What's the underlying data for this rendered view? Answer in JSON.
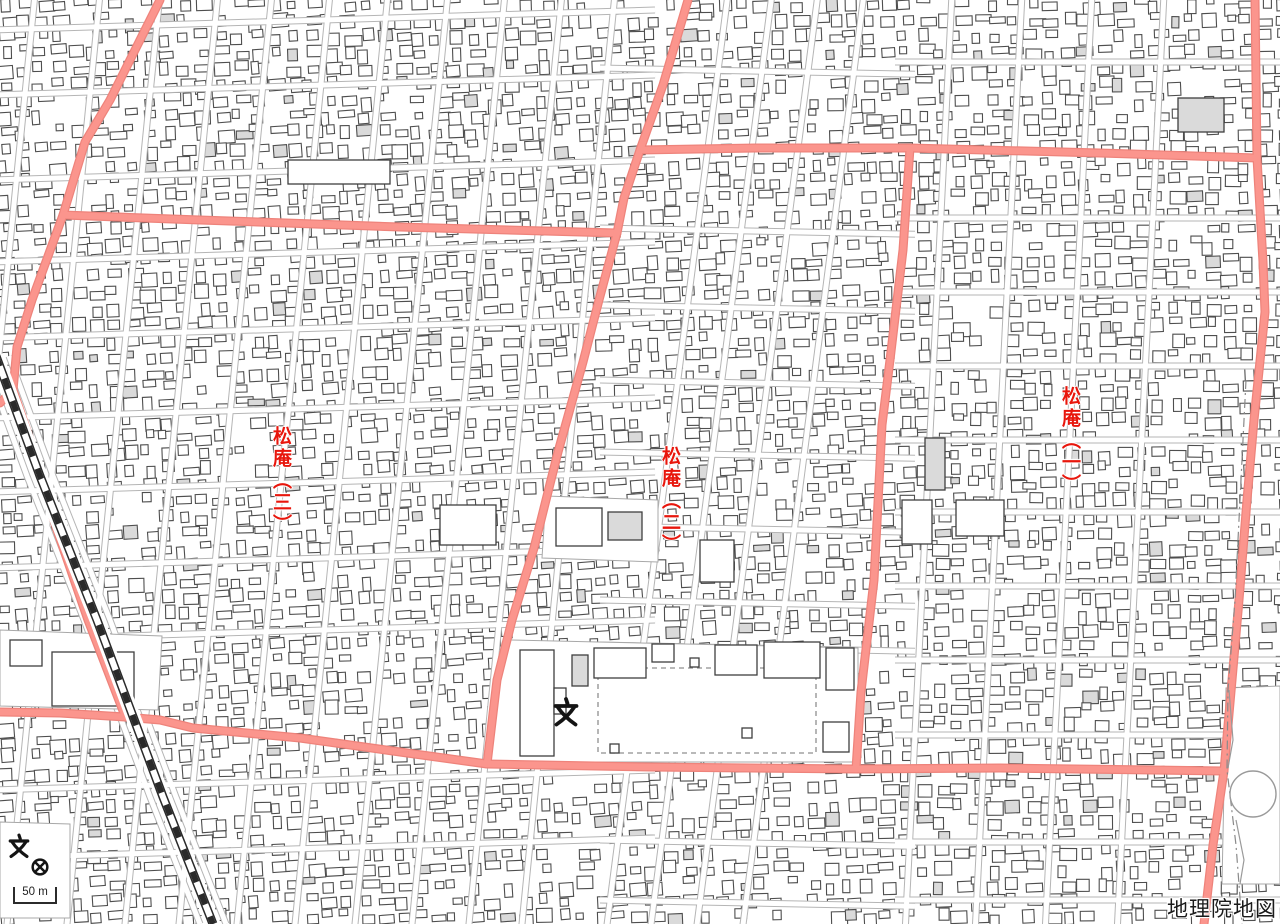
{
  "map": {
    "width": 1280,
    "height": 924,
    "background": "#ffffff"
  },
  "colors": {
    "road_pink": "#fb958d",
    "road_pink_edge": "#ee837b",
    "street_edge": "#b5b5b5",
    "street_fill": "#ffffff",
    "building_stroke": "#4e4e4e",
    "building_gray": "#dadada",
    "label_red": "#e8160c",
    "rail_dark": "#2a2a2a",
    "parcel_edge": "#a8a8a8"
  },
  "attribution": {
    "text": "地理院地図"
  },
  "scale_bar": {
    "label": "50 m",
    "x": 14,
    "y_top": 887,
    "y_bottom": 903,
    "width": 42
  },
  "district_labels": [
    {
      "text": "松庵（三）",
      "x": 283,
      "y": 426
    },
    {
      "text": "松庵（二）",
      "x": 672,
      "y": 446
    },
    {
      "text": "松庵（一）",
      "x": 1072,
      "y": 386
    }
  ],
  "symbols": [
    {
      "kind": "school",
      "x": 566,
      "y": 712,
      "size": 30
    },
    {
      "kind": "school",
      "x": 19,
      "y": 846,
      "size": 25
    },
    {
      "kind": "police_station",
      "x": 40,
      "y": 867,
      "size": 22
    }
  ],
  "major_roads": [
    {
      "id": "railside-road",
      "points": [
        [
          160,
          0
        ],
        [
          110,
          100
        ],
        [
          85,
          142
        ],
        [
          63,
          215
        ],
        [
          32,
          300
        ],
        [
          17,
          347
        ],
        [
          13,
          390
        ],
        [
          30,
          440
        ],
        [
          57,
          530
        ],
        [
          88,
          620
        ],
        [
          125,
          716
        ]
      ]
    },
    {
      "id": "railside-spur",
      "points": [
        [
          13,
          390
        ],
        [
          0,
          403
        ]
      ]
    },
    {
      "id": "upper-west-road",
      "points": [
        [
          63,
          215
        ],
        [
          200,
          220
        ],
        [
          400,
          227
        ],
        [
          617,
          233
        ]
      ]
    },
    {
      "id": "main-diagonal-road",
      "points": [
        [
          688,
          0
        ],
        [
          663,
          85
        ],
        [
          640,
          150
        ],
        [
          624,
          198
        ],
        [
          617,
          233
        ],
        [
          599,
          300
        ],
        [
          583,
          362
        ],
        [
          558,
          452
        ],
        [
          534,
          548
        ],
        [
          512,
          620
        ],
        [
          497,
          680
        ],
        [
          487,
          764
        ]
      ]
    },
    {
      "id": "upper-east-road",
      "points": [
        [
          640,
          150
        ],
        [
          755,
          148
        ],
        [
          910,
          148
        ],
        [
          1100,
          153
        ],
        [
          1257,
          158
        ]
      ]
    },
    {
      "id": "mid-vertical-road",
      "points": [
        [
          910,
          148
        ],
        [
          903,
          250
        ],
        [
          890,
          360
        ],
        [
          882,
          425
        ],
        [
          874,
          580
        ],
        [
          861,
          692
        ],
        [
          856,
          769
        ]
      ]
    },
    {
      "id": "bottom-road",
      "points": [
        [
          0,
          712
        ],
        [
          60,
          713
        ],
        [
          125,
          717
        ],
        [
          160,
          720
        ],
        [
          193,
          728
        ],
        [
          300,
          738
        ],
        [
          400,
          752
        ],
        [
          487,
          764
        ],
        [
          650,
          767
        ],
        [
          856,
          769
        ],
        [
          1000,
          768
        ],
        [
          1224,
          771
        ]
      ]
    },
    {
      "id": "right-vertical-road",
      "points": [
        [
          1255,
          0
        ],
        [
          1257,
          158
        ],
        [
          1263,
          262
        ],
        [
          1265,
          312
        ],
        [
          1254,
          420
        ],
        [
          1247,
          500
        ],
        [
          1239,
          600
        ],
        [
          1232,
          680
        ],
        [
          1224,
          771
        ],
        [
          1213,
          845
        ],
        [
          1204,
          924
        ]
      ]
    }
  ],
  "railway": {
    "points": [
      [
        -4,
        356
      ],
      [
        40,
        476
      ],
      [
        97,
        620
      ],
      [
        163,
        797
      ],
      [
        213,
        924
      ]
    ]
  },
  "streets": {
    "zones": [
      {
        "name": "west",
        "x0": -10,
        "x1": 655,
        "verticals": {
          "xs": [
            35,
            100,
            160,
            218,
            272,
            330,
            388,
            448,
            505,
            562,
            615
          ],
          "lean": -0.1
        },
        "horizontals": {
          "ys": [
            30,
            95,
            180,
            262,
            338,
            418,
            492,
            568,
            640,
            790,
            858
          ],
          "slope": -0.03
        }
      },
      {
        "name": "center",
        "x0": 600,
        "x1": 915,
        "verticals": {
          "xs": [
            728,
            772,
            818,
            864
          ],
          "lean": -0.13
        },
        "horizontals": {
          "ys": [
            68,
            228,
            305,
            380,
            452,
            526,
            600,
            645,
            840,
            900
          ],
          "slope": 0.02
        }
      },
      {
        "name": "east",
        "x0": 895,
        "x1": 1280,
        "verticals": {
          "xs": [
            952,
            1022,
            1092,
            1164
          ],
          "lean": -0.05
        },
        "horizontals": {
          "ys": [
            62,
            218,
            292,
            366,
            440,
            512,
            586,
            660,
            735,
            842,
            900
          ],
          "slope": 0
        }
      }
    ],
    "extra": [
      {
        "points": [
          [
            -17,
            356
          ],
          [
            27,
            476
          ],
          [
            84,
            620
          ],
          [
            150,
            797
          ],
          [
            200,
            924
          ]
        ]
      },
      {
        "points": [
          [
            9,
            356
          ],
          [
            53,
            476
          ],
          [
            110,
            620
          ],
          [
            176,
            797
          ],
          [
            226,
            924
          ]
        ]
      }
    ]
  },
  "parcels": [
    {
      "id": "school-campus",
      "polygon": [
        [
          512,
          640
        ],
        [
          858,
          648
        ],
        [
          858,
          762
        ],
        [
          486,
          762
        ],
        [
          504,
          640
        ]
      ],
      "dashed_rect": {
        "x": 598,
        "y": 668,
        "w": 218,
        "h": 85
      },
      "buildings": [
        {
          "x": 520,
          "y": 650,
          "w": 34,
          "h": 106,
          "fill": "white"
        },
        {
          "x": 554,
          "y": 688,
          "w": 12,
          "h": 26,
          "fill": "white"
        },
        {
          "x": 572,
          "y": 655,
          "w": 16,
          "h": 31,
          "fill": "gray"
        },
        {
          "x": 594,
          "y": 648,
          "w": 52,
          "h": 30,
          "fill": "white"
        },
        {
          "x": 652,
          "y": 644,
          "w": 22,
          "h": 18,
          "fill": "white"
        },
        {
          "x": 690,
          "y": 658,
          "w": 9,
          "h": 9,
          "fill": "white"
        },
        {
          "x": 715,
          "y": 645,
          "w": 42,
          "h": 30,
          "fill": "white"
        },
        {
          "x": 764,
          "y": 642,
          "w": 56,
          "h": 36,
          "fill": "white"
        },
        {
          "x": 826,
          "y": 648,
          "w": 28,
          "h": 42,
          "fill": "white"
        },
        {
          "x": 823,
          "y": 722,
          "w": 26,
          "h": 30,
          "fill": "white"
        },
        {
          "x": 610,
          "y": 744,
          "w": 9,
          "h": 9,
          "fill": "white"
        },
        {
          "x": 742,
          "y": 728,
          "w": 10,
          "h": 10,
          "fill": "white"
        }
      ]
    },
    {
      "id": "west-block",
      "polygon": [
        [
          0,
          630
        ],
        [
          162,
          636
        ],
        [
          158,
          710
        ],
        [
          0,
          706
        ]
      ],
      "buildings": [
        {
          "x": 10,
          "y": 640,
          "w": 32,
          "h": 26,
          "fill": "white"
        },
        {
          "x": 52,
          "y": 652,
          "w": 82,
          "h": 54,
          "fill": "white"
        }
      ]
    },
    {
      "id": "mid-block",
      "polygon": [
        [
          546,
          496
        ],
        [
          658,
          500
        ],
        [
          658,
          562
        ],
        [
          542,
          558
        ]
      ],
      "buildings": [
        {
          "x": 556,
          "y": 508,
          "w": 46,
          "h": 38,
          "fill": "white"
        },
        {
          "x": 608,
          "y": 512,
          "w": 34,
          "h": 28,
          "fill": "gray"
        }
      ]
    },
    {
      "id": "sw-corner-block",
      "polygon": [
        [
          0,
          822
        ],
        [
          70,
          824
        ],
        [
          70,
          918
        ],
        [
          0,
          918
        ]
      ],
      "buildings": []
    },
    {
      "id": "se-block",
      "polygon": [
        [
          1226,
          688
        ],
        [
          1280,
          686
        ],
        [
          1280,
          884
        ],
        [
          1222,
          884
        ]
      ],
      "buildings": []
    }
  ],
  "feature_buildings": [
    {
      "x": 288,
      "y": 160,
      "w": 102,
      "h": 24,
      "fill": "white"
    },
    {
      "x": 925,
      "y": 438,
      "w": 20,
      "h": 52,
      "fill": "gray"
    },
    {
      "x": 956,
      "y": 500,
      "w": 48,
      "h": 36,
      "fill": "white"
    },
    {
      "x": 902,
      "y": 500,
      "w": 30,
      "h": 44,
      "fill": "white"
    },
    {
      "x": 1178,
      "y": 98,
      "w": 46,
      "h": 34,
      "fill": "gray"
    },
    {
      "x": 700,
      "y": 540,
      "w": 34,
      "h": 42,
      "fill": "white"
    },
    {
      "x": 440,
      "y": 505,
      "w": 56,
      "h": 40,
      "fill": "white"
    }
  ],
  "circle_feature": {
    "cx": 1253,
    "cy": 794,
    "r": 23
  },
  "se_paths": [
    {
      "points": [
        [
          1229,
          690
        ],
        [
          1233,
          740
        ],
        [
          1228,
          768
        ]
      ]
    },
    {
      "points": [
        [
          1236,
          820
        ],
        [
          1244,
          860
        ],
        [
          1240,
          884
        ]
      ]
    }
  ],
  "boundary_line": {
    "points": [
      [
        1246,
        380
      ],
      [
        1240,
        500
      ],
      [
        1235,
        600
      ],
      [
        1228,
        690
      ],
      [
        1227,
        770
      ],
      [
        1236,
        845
      ],
      [
        1242,
        924
      ]
    ],
    "dash": "9 4 2 4"
  },
  "buildings_spec": {
    "seed": 1337,
    "cell_w": 18,
    "cell_h": 16,
    "density": 0.86,
    "gray_prob": 0.055,
    "min_w": 7,
    "max_w": 17,
    "min_h": 6,
    "max_h": 14,
    "zones": [
      {
        "x_max": 640,
        "angle": -3
      },
      {
        "x_max": 900,
        "angle": -2
      },
      {
        "x_max": 1281,
        "angle": -1
      }
    ]
  }
}
